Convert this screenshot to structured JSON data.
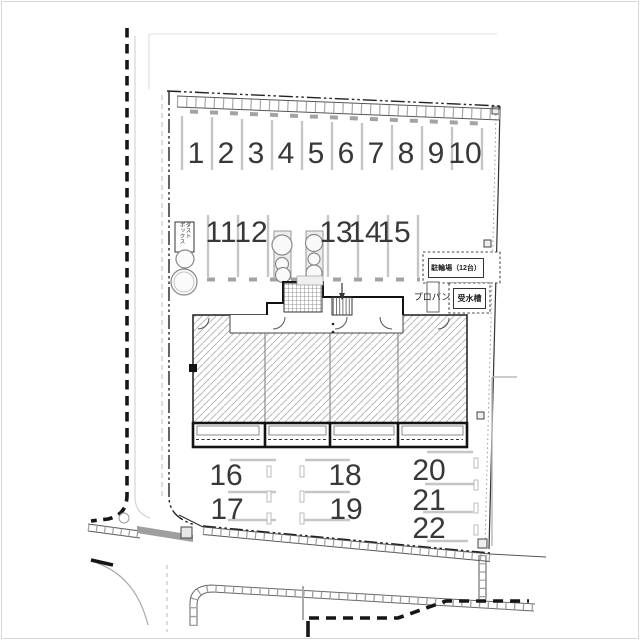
{
  "plan": {
    "type": "site-plan",
    "parking_row_top": [
      "1",
      "2",
      "3",
      "4",
      "5",
      "6",
      "7",
      "8",
      "9",
      "10"
    ],
    "parking_row_middle": [
      "11",
      "12",
      "13",
      "14",
      "15"
    ],
    "parking_bottom_left": [
      "16",
      "17"
    ],
    "parking_bottom_center": [
      "18",
      "19"
    ],
    "parking_bottom_right": [
      "20",
      "21",
      "22"
    ],
    "labels": {
      "bicycle_parking": "駐輪場（12台）",
      "propane": "プロパン",
      "water_tank": "受水槽",
      "dust_box_line1": "ダスト",
      "dust_box_line2": "ボックス"
    },
    "colors": {
      "line_dark": "#2a2a2a",
      "divider_gray": "#c6c6c6",
      "hatch_gray": "#b9b9b9",
      "wall_gray": "#9f9f9f"
    }
  }
}
